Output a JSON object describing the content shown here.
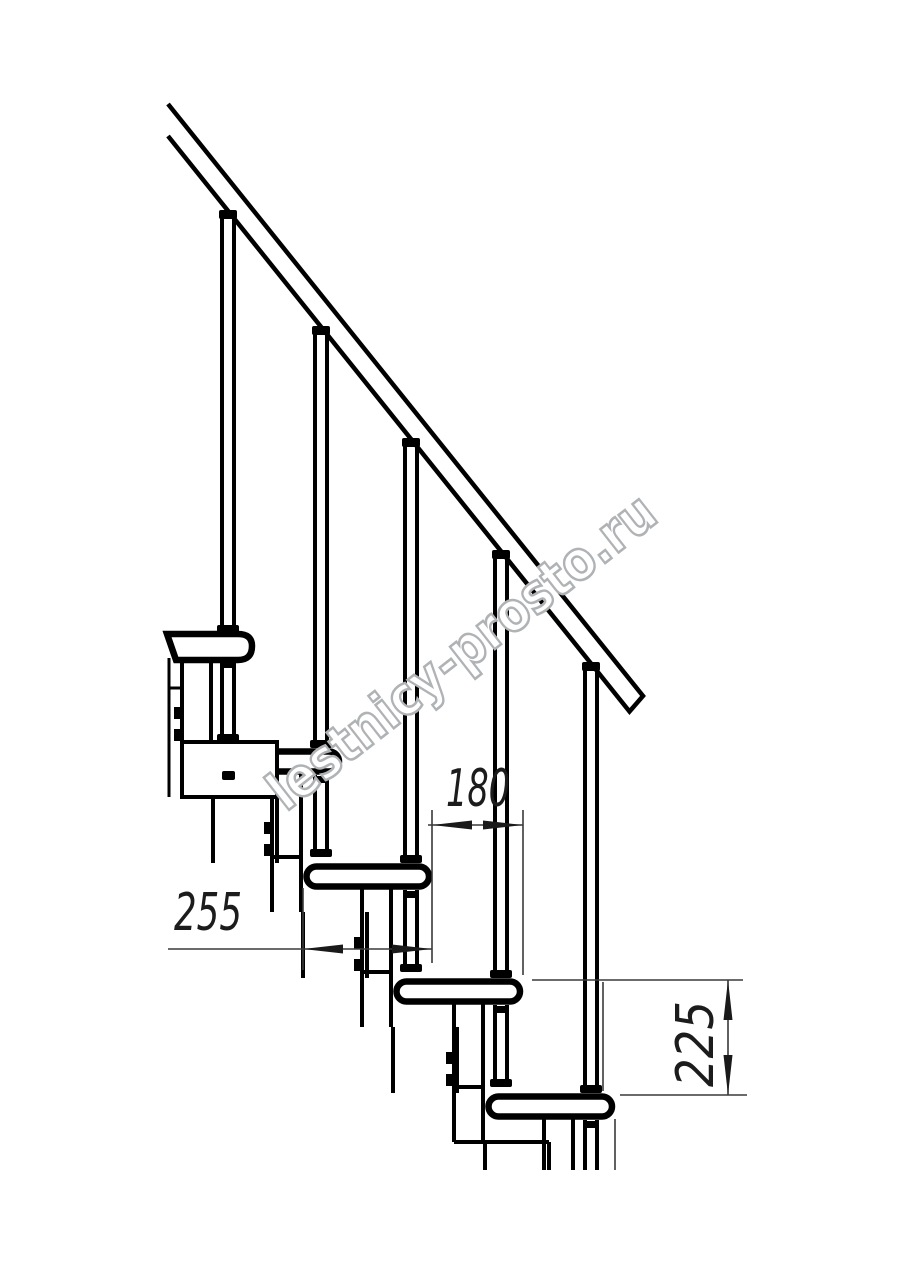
{
  "drawing": {
    "type": "staircase-side-elevation-technical-drawing",
    "steps_visible": 5,
    "line_color": "#000000",
    "dimension_line_color": "#3a3a3a",
    "watermark_color": "#b0b3b5",
    "watermark_text": "lestnicy-prosto.ru",
    "dimensions": {
      "step_offset": "180",
      "tread_depth": "255",
      "step_rise": "225"
    }
  }
}
